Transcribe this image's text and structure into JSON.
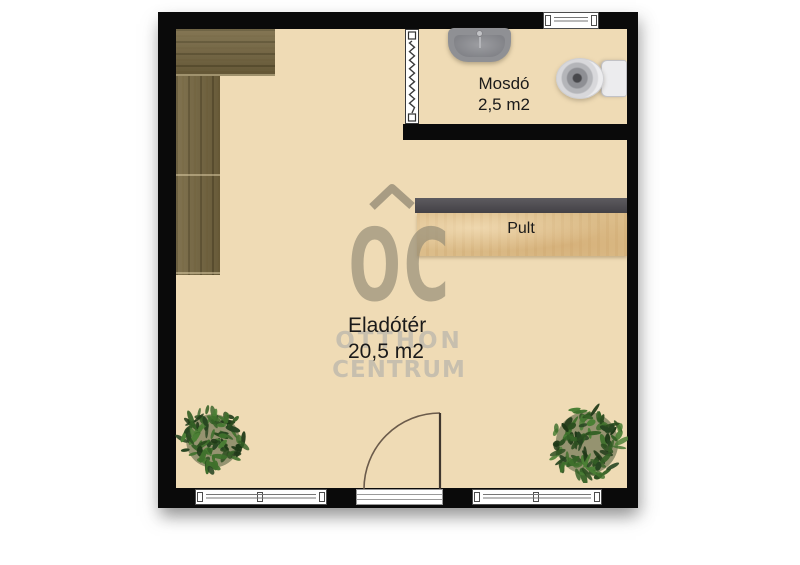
{
  "plan": {
    "rooms": [
      {
        "name": "Eladótér",
        "area": "20,5 m2"
      },
      {
        "name": "Mosdó",
        "area": "2,5 m2"
      }
    ],
    "furniture": [
      {
        "type": "counter",
        "label": "Pult"
      }
    ],
    "fixtures": [
      "sink",
      "toilet",
      "plant",
      "plant",
      "cabinet",
      "accordion-door",
      "entrance-door",
      "window"
    ]
  },
  "watermark": {
    "logo": "OC",
    "line1": "OTTHON",
    "line2": "CENTRUM"
  },
  "colors": {
    "floor": "#efdbb5",
    "wall": "#0a0a0a",
    "cabinet_wood": "#766741",
    "counter_wood": "#dcbd8a",
    "counter_top": "#4d4b4f",
    "plant_green": "#3a6429",
    "watermark_gray": "#948c76",
    "watermark_light": "#c4bdae",
    "fixture_gray": "#8f9094",
    "label_ink": "#1a1a1a"
  }
}
